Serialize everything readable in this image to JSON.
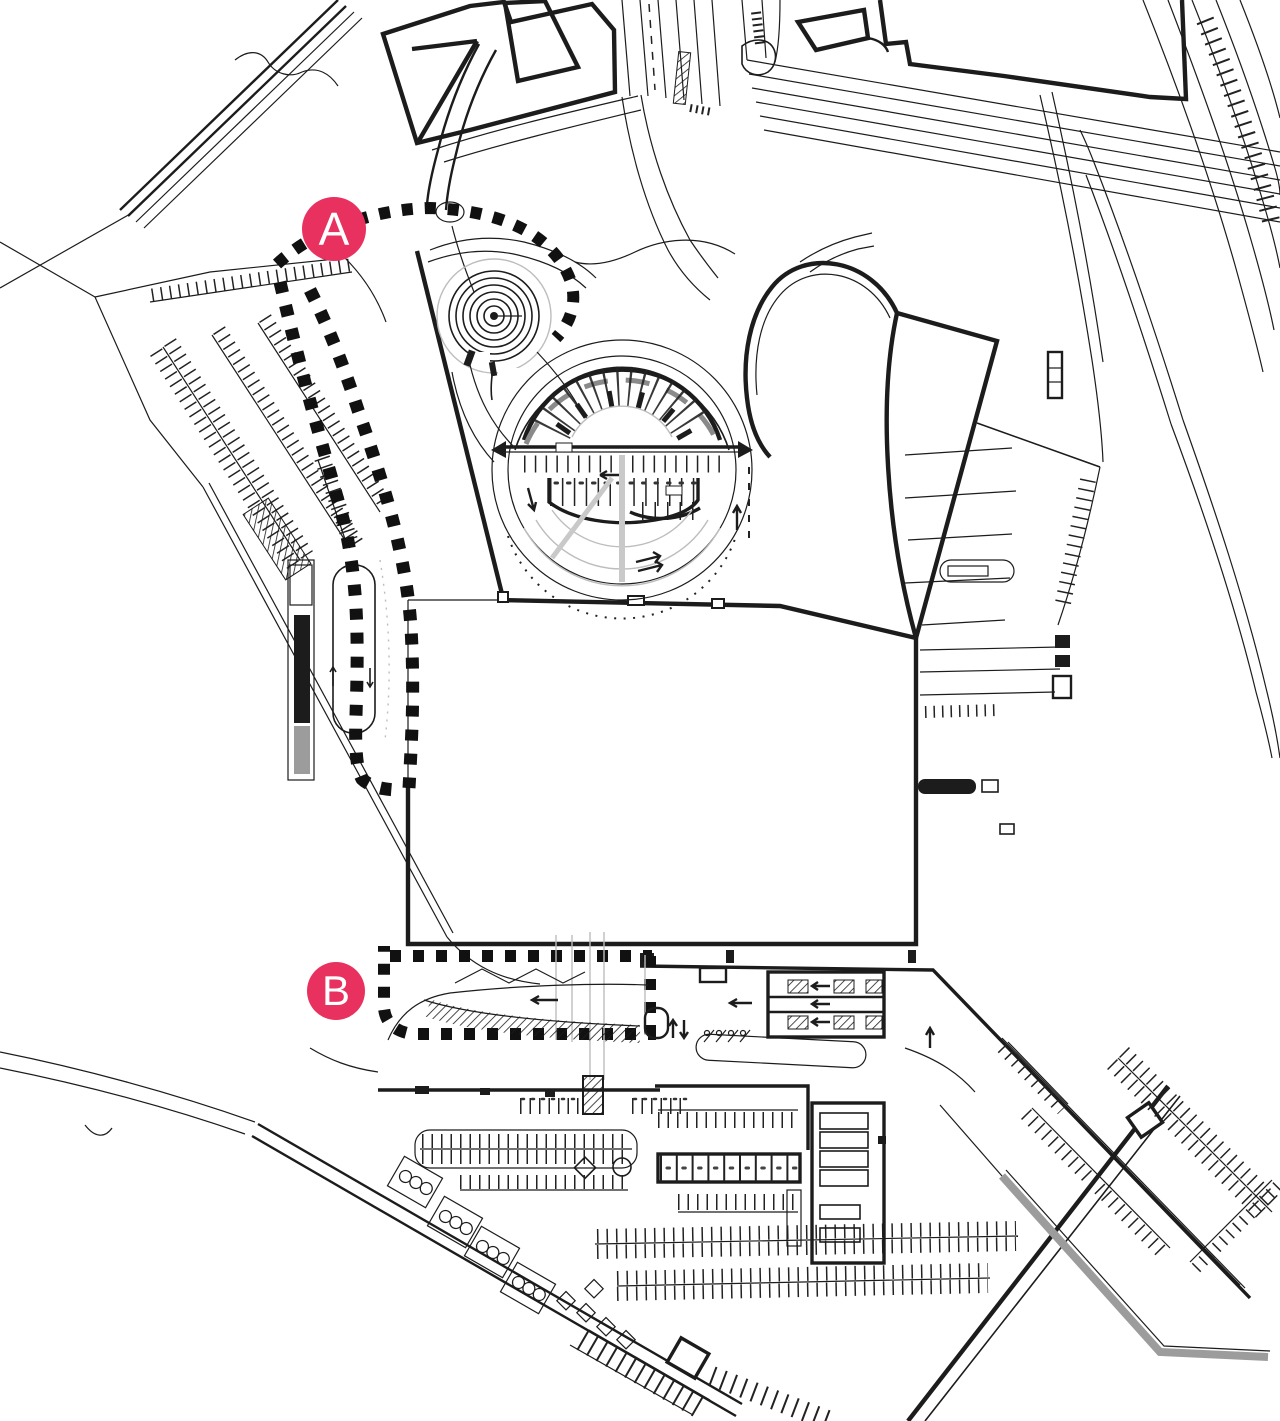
{
  "drawing": {
    "kind": "architectural site plan",
    "markers": {
      "a": {
        "label": "A"
      },
      "b": {
        "label": "B"
      }
    }
  },
  "colors": {
    "marker": "#e8315e",
    "marker_text": "#ffffff",
    "ink": "#1c1c1c",
    "gray": "#9c9c9c",
    "light": "#bdbdbd",
    "canopy": "#8a8a8a",
    "paper": "#ffffff"
  }
}
